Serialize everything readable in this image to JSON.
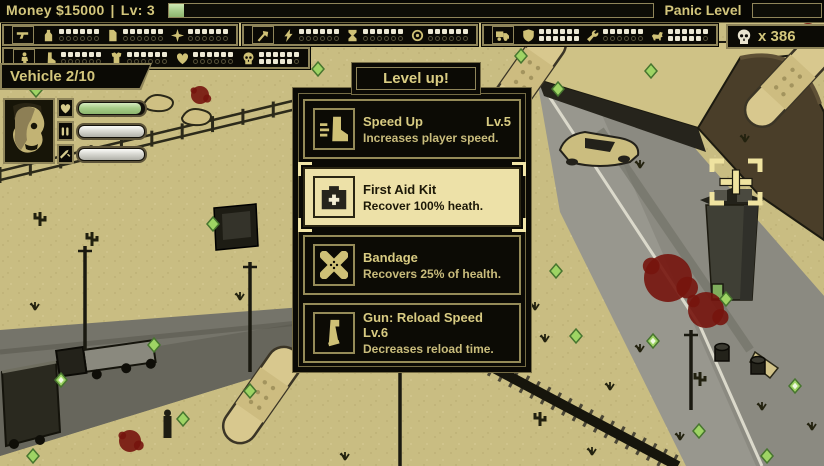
{
  "colors": {
    "accent_gold": "#cfc176",
    "panel_bg": "#0b0a05",
    "sand": "#c9bd82",
    "selected_bg": "#ede1a8",
    "xp_green": "#a9cd8d",
    "gem_green": "#9ed464",
    "blood_red": "#75140d"
  },
  "hud": {
    "money": "Money $15000",
    "divider": "|",
    "level": "Lv: 3",
    "xp_percent": 3,
    "panic_label": "Panic Level",
    "panic_percent": 0,
    "kill_counter": {
      "icon": "skull-icon",
      "label": "x 386"
    },
    "vehicle_label": "Vehicle 2/10"
  },
  "upgrade_panels": [
    {
      "group_icon": "pistol-icon",
      "slots": [
        {
          "icon": "bottle-icon",
          "filled": 6,
          "total": 12
        },
        {
          "icon": "scroll-icon",
          "filled": 6,
          "total": 12
        },
        {
          "icon": "star-icon",
          "filled": 6,
          "total": 12
        }
      ]
    },
    {
      "group_icon": "axe-icon",
      "slots": [
        {
          "icon": "lightning-icon",
          "filled": 6,
          "total": 12
        },
        {
          "icon": "hourglass-icon",
          "filled": 6,
          "total": 12
        },
        {
          "icon": "target-icon",
          "filled": 6,
          "total": 12
        }
      ]
    },
    {
      "group_icon": "truck-icon",
      "slots": [
        {
          "icon": "shield-icon",
          "filled": 12,
          "total": 12
        },
        {
          "icon": "wrench-icon",
          "filled": 6,
          "total": 12
        },
        {
          "icon": "dog-icon",
          "filled": 11,
          "total": 12
        }
      ]
    },
    {
      "group_icon": "person-icon",
      "slots": [
        {
          "icon": "boot-icon",
          "filled": 6,
          "total": 12
        },
        {
          "icon": "armor-icon",
          "filled": 6,
          "total": 12
        },
        {
          "icon": "heart-icon",
          "filled": 6,
          "total": 12
        },
        {
          "icon": "skull-icon",
          "filled": 11,
          "total": 12
        }
      ]
    }
  ],
  "player": {
    "bars": [
      {
        "icon": "heart-icon",
        "color": "green",
        "percent": 96
      },
      {
        "icon": "ammo-icon",
        "color": "silver",
        "percent": 100
      },
      {
        "icon": "knife-icon",
        "color": "silver",
        "percent": 100
      }
    ]
  },
  "dialog": {
    "title": "Level up!",
    "options": [
      {
        "icon": "speed-boot-icon",
        "name": "Speed Up",
        "level": "Lv.5",
        "desc": "Increases player speed.",
        "selected": false
      },
      {
        "icon": "first-aid-icon",
        "name": "First Aid Kit",
        "level": "",
        "desc": "Recover 100% heath.",
        "selected": true
      },
      {
        "icon": "bandage-icon",
        "name": "Bandage",
        "level": "",
        "desc": "Recovers 25% of health.",
        "selected": false
      },
      {
        "icon": "magazine-icon",
        "name": "Gun: Reload Speed Lv.6",
        "level": "",
        "desc": "Decreases reload time.",
        "selected": false
      }
    ]
  },
  "scene": {
    "gems": [
      [
        318,
        69,
        0
      ],
      [
        334,
        98,
        0
      ],
      [
        445,
        73,
        0
      ],
      [
        489,
        31,
        1
      ],
      [
        521,
        56,
        0
      ],
      [
        558,
        89,
        0
      ],
      [
        651,
        71,
        0
      ],
      [
        427,
        247,
        1
      ],
      [
        447,
        257,
        0
      ],
      [
        556,
        271,
        0
      ],
      [
        213,
        224,
        0
      ],
      [
        154,
        345,
        0
      ],
      [
        250,
        391,
        0
      ],
      [
        576,
        336,
        0
      ],
      [
        653,
        341,
        1
      ],
      [
        699,
        431,
        0
      ],
      [
        767,
        456,
        0
      ],
      [
        795,
        386,
        1
      ],
      [
        726,
        299,
        0
      ],
      [
        33,
        456,
        0
      ],
      [
        61,
        380,
        1
      ],
      [
        183,
        419,
        0
      ],
      [
        36,
        90,
        0
      ]
    ],
    "blood": [
      [
        200,
        95,
        9
      ],
      [
        668,
        278,
        24
      ],
      [
        706,
        310,
        18
      ],
      [
        130,
        441,
        11
      ],
      [
        808,
        14,
        10
      ],
      [
        692,
        7,
        6
      ],
      [
        430,
        352,
        8
      ],
      [
        372,
        358,
        7
      ]
    ],
    "cacti": [
      [
        40,
        226
      ],
      [
        92,
        246
      ],
      [
        540,
        426
      ],
      [
        700,
        386
      ]
    ],
    "tufts": [
      [
        640,
        352
      ],
      [
        762,
        410
      ],
      [
        812,
        430
      ],
      [
        420,
        300
      ],
      [
        35,
        310
      ],
      [
        592,
        455
      ],
      [
        345,
        460
      ],
      [
        745,
        142
      ],
      [
        640,
        168
      ],
      [
        545,
        342
      ],
      [
        610,
        390
      ],
      [
        680,
        440
      ],
      [
        240,
        300
      ],
      [
        535,
        310
      ]
    ],
    "poles": [
      [
        85,
        246,
        104
      ],
      [
        250,
        262,
        110
      ],
      [
        400,
        298,
        168
      ],
      [
        691,
        330,
        80
      ]
    ],
    "bandages": [
      [
        262,
        395,
        -55
      ],
      [
        527,
        75,
        -55
      ],
      [
        788,
        82,
        -47
      ]
    ],
    "barrels": [
      [
        722,
        352
      ],
      [
        758,
        365
      ]
    ],
    "rocks": [
      [
        158,
        104
      ],
      [
        196,
        118
      ]
    ],
    "person": [
      167,
      432
    ],
    "fence": {
      "x1": 0,
      "y1": 180,
      "x2": 334,
      "y2": 100,
      "posts": 12
    }
  }
}
